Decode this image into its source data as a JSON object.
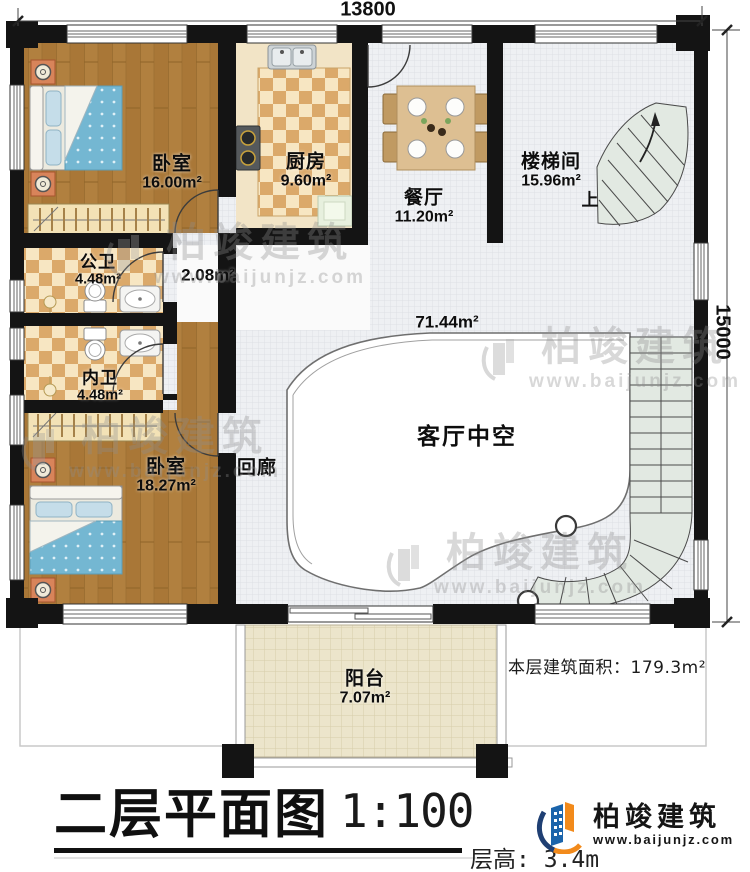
{
  "drawing": {
    "dimensions": {
      "top": "13800",
      "right": "15000"
    },
    "rooms": [
      {
        "name": "卧室",
        "area": "16.00m²"
      },
      {
        "name": "厨房",
        "area": "9.60m²"
      },
      {
        "name": "餐厅",
        "area": "11.20m²"
      },
      {
        "name": "楼梯间",
        "area": "15.96m²"
      },
      {
        "name": "公卫",
        "area": "4.48m²"
      },
      {
        "name": "",
        "area": "2.08m²"
      },
      {
        "name": "内卫",
        "area": "4.48m²"
      },
      {
        "name": "卧室",
        "area": "18.27m²"
      },
      {
        "name": "回廊",
        "area": ""
      },
      {
        "name": "客厅中空",
        "area": "71.44m²"
      },
      {
        "name": "阳台",
        "area": "7.07m²"
      }
    ],
    "stairs": {
      "up_label": "上"
    },
    "summary": {
      "floor_area_label": "本层建筑面积：",
      "floor_area_value": "179.3m²",
      "floor_height_label": "层高:",
      "floor_height_value": "3.4m"
    },
    "title": {
      "text": "二层平面图",
      "scale": "1:100"
    },
    "branding": {
      "company": "柏竣建筑",
      "website": "www.baijunjz.com"
    },
    "watermark": {
      "company": "柏竣建筑",
      "website": "www.baijunjz.com"
    },
    "colors": {
      "wall": "#141414",
      "wood_floor": "#b1803f",
      "tile_light": "#f7e6c2",
      "tile_dark": "#dba96a",
      "corridor_tile": "#eef0f3",
      "stair_fill": "#e2e9e2",
      "balcony_floor": "#ece5cb",
      "bed_blue": "#74b7d2",
      "logo_blue": "#1b64ab",
      "logo_orange": "#f28a1b"
    }
  }
}
